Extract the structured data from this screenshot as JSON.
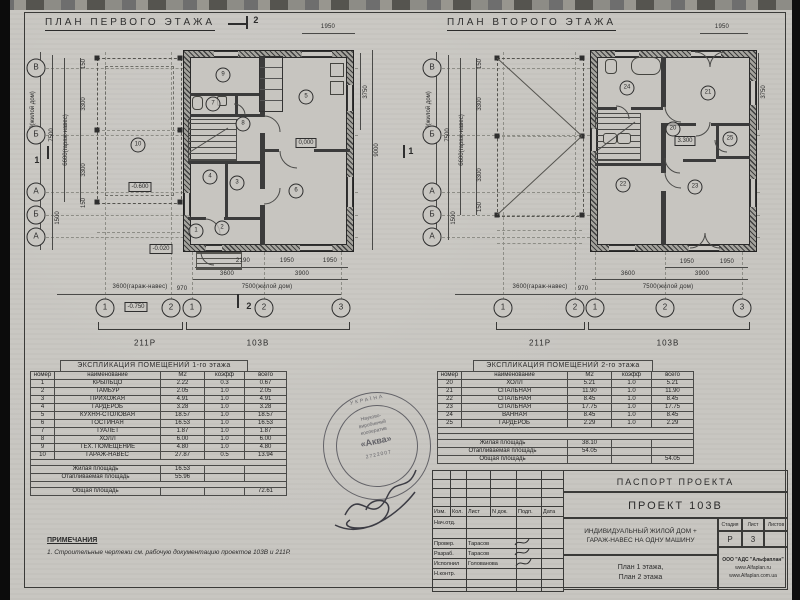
{
  "plan1": {
    "title": "ПЛАН ПЕРВОГО ЭТАЖА",
    "rooms": [
      "1",
      "2",
      "3",
      "4",
      "5",
      "6",
      "7",
      "8",
      "9",
      "10"
    ],
    "levels": {
      "floor": "0,000",
      "garage": "-0.600",
      "entry": "-0.020",
      "porch": "-0.750"
    },
    "axes_left": [
      "В",
      "Б",
      "А",
      "Б",
      "А"
    ],
    "axes_bottom": [
      "1",
      "2",
      "1",
      "2",
      "3"
    ],
    "dim_top": "1950",
    "dims_left": [
      "9000(жилой дом)",
      "7500",
      "6600(гараж-навес)",
      "150",
      "3300",
      "3300",
      "150",
      "1500"
    ],
    "dims_right": [
      "3750",
      "9000"
    ],
    "dims_bottom1": [
      "2190",
      "1950",
      "1950"
    ],
    "dims_bottom2": [
      "3600",
      "3900"
    ],
    "dims_bottom3": [
      "3600(гараж-навес)",
      "970",
      "7500(жилой дом)"
    ],
    "sections": {
      "top": "2",
      "bottom": "2",
      "left": "1",
      "right": "1"
    },
    "brackets": [
      "211Р",
      "103В"
    ]
  },
  "plan2": {
    "title": "ПЛАН ВТОРОГО ЭТАЖА",
    "rooms": [
      "20",
      "21",
      "22",
      "23",
      "24",
      "25"
    ],
    "levels": {
      "floor": "3.300"
    },
    "axes_left": [
      "В",
      "Б",
      "А",
      "Б",
      "А"
    ],
    "axes_bottom": [
      "1",
      "2",
      "1",
      "2",
      "3"
    ],
    "dim_top": "1950",
    "dims_left": [
      "9000(жилой дом)",
      "7500",
      "6600(гараж-навес)",
      "150",
      "3300",
      "3300",
      "150",
      "1500"
    ],
    "dims_right": [
      "3750"
    ],
    "dims_bottom1": [
      "1950",
      "1950"
    ],
    "dims_bottom2": [
      "3600",
      "3900"
    ],
    "dims_bottom3": [
      "3600(гараж-навес)",
      "970",
      "7500(жилой дом)"
    ],
    "brackets": [
      "211Р",
      "103В"
    ]
  },
  "tables": {
    "floor1": {
      "title": "ЭКСПЛИКАЦИЯ ПОМЕЩЕНИЙ 1-го этажа",
      "headers": [
        "номер",
        "наименование",
        "М2",
        "коэфф",
        "всего"
      ],
      "rows": [
        [
          "1",
          "КРЫЛЬЦО",
          "2.22",
          "0.3",
          "0.67"
        ],
        [
          "2",
          "ТАМБУР",
          "2.05",
          "1.0",
          "2.05"
        ],
        [
          "3",
          "ПРИХОЖАЯ",
          "4.91",
          "1.0",
          "4.91"
        ],
        [
          "4",
          "ГАРДЕРОБ",
          "3.28",
          "1.0",
          "3.28"
        ],
        [
          "5",
          "КУХНЯ-СТОЛОВАЯ",
          "18.57",
          "1.0",
          "18.57"
        ],
        [
          "6",
          "ГОСТИНАЯ",
          "16.53",
          "1.0",
          "16.53"
        ],
        [
          "7",
          "ТУАЛЕТ",
          "1.87",
          "1.0",
          "1.87"
        ],
        [
          "8",
          "ХОЛЛ",
          "6.00",
          "1.0",
          "6.00"
        ],
        [
          "9",
          "ТЕХ. ПОМЕЩЕНИЕ",
          "4.80",
          "1.0",
          "4.80"
        ],
        [
          "10",
          "ГАРАЖ-НАВЕС",
          "27.87",
          "0.5",
          "13.94"
        ]
      ],
      "summary": [
        {
          "label": "Жилая площадь",
          "m2": "16.53",
          "total": ""
        },
        {
          "label": "Отапливаемая площадь",
          "m2": "55.96",
          "total": ""
        },
        {
          "label": "Общая площадь",
          "m2": "",
          "total": "72.61"
        }
      ]
    },
    "floor2": {
      "title": "ЭКСПЛИКАЦИЯ ПОМЕЩЕНИЙ 2-го этажа",
      "headers": [
        "номер",
        "наименование",
        "М2",
        "коэфф",
        "всего"
      ],
      "rows": [
        [
          "20",
          "ХОЛЛ",
          "5.21",
          "1.0",
          "5.21"
        ],
        [
          "21",
          "СПАЛЬНАЯ",
          "11.90",
          "1.0",
          "11.90"
        ],
        [
          "22",
          "СПАЛЬНАЯ",
          "8.45",
          "1.0",
          "8.45"
        ],
        [
          "23",
          "СПАЛЬНАЯ",
          "17.75",
          "1.0",
          "17.75"
        ],
        [
          "24",
          "ВАННАЯ",
          "8.45",
          "1.0",
          "8.45"
        ],
        [
          "25",
          "ГАРДЕРОБ",
          "2.29",
          "1.0",
          "2.29"
        ]
      ],
      "summary": [
        {
          "label": "Жилая площадь",
          "m2": "38.10",
          "total": ""
        },
        {
          "label": "Отапливаемая площадь",
          "m2": "54.05",
          "total": ""
        },
        {
          "label": "Общая площадь",
          "m2": "",
          "total": "54.05"
        }
      ]
    }
  },
  "titleblock": {
    "passport": "ПАСПОРТ ПРОЕКТА",
    "project": "ПРОЕКТ 103В",
    "cols": [
      "Изм.",
      "Кол.",
      "Лист",
      "N док.",
      "Подп.",
      "Дата"
    ],
    "rows": [
      {
        "role": "Нач.отд.",
        "name": ""
      },
      {
        "role": "",
        "name": ""
      },
      {
        "role": "Провер.",
        "name": "Тарасов"
      },
      {
        "role": "Разраб.",
        "name": "Тарасов"
      },
      {
        "role": "Исполнил",
        "name": "Голованова"
      },
      {
        "role": "Н.контр.",
        "name": ""
      }
    ],
    "description_line1": "ИНДИВИДУАЛЬНЫЙ ЖИЛОЙ ДОМ +",
    "description_line2": "ГАРАЖ-НАВЕС НА ОДНУ МАШИНУ",
    "stage_label": "Стадия",
    "sheet_label": "Лист",
    "sheets_label": "Листов",
    "stage": "Р",
    "sheet": "3",
    "sheets": "",
    "sheet_title_line1": "План 1 этажа,",
    "sheet_title_line2": "План 2 этажа",
    "company_line1": "ООО \"АДС \"Альфаплан\"",
    "company_line2": "www.Alfaplan.ru",
    "company_line3": "www.Alfaplan.com.ua"
  },
  "stamp": {
    "arc_top": "УКРАЇНА",
    "line1": "Науково-",
    "line2": "виробничий",
    "line3": "кооператив",
    "name": "«Аква»",
    "number": "2722007"
  },
  "notes": {
    "title": "ПРИМЕЧАНИЯ",
    "item1": "1. Строительные чертежи см. рабочую документацию проектов 103В и 211Р."
  }
}
